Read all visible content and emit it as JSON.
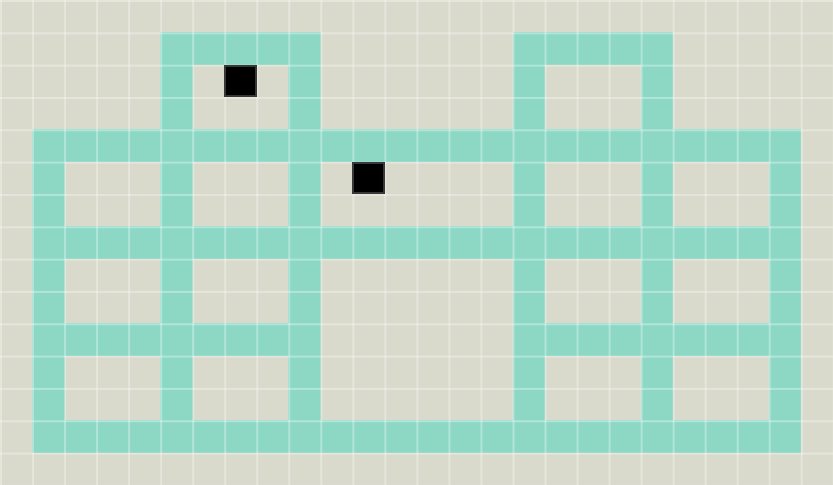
{
  "board": {
    "cols": 26,
    "rows": 15,
    "tile_size_px": 32,
    "legend": {
      ".": "floor",
      "W": "wall",
      "B": "black-block"
    },
    "rows_map": [
      "..........................",
      ".....WWWWW......WWWWW.....",
      ".....W.B.W......W...W.....",
      ".....W...W......W...W.....",
      ".WWWWWWWWWWWWWWWWWWWWWWWW.",
      ".W...W...W.B....W...W...W.",
      ".W...W...W......W...W...W.",
      ".WWWWWWWWWWWWWWWWWWWWWWWW.",
      ".W...W...W......W...W...W.",
      ".W...W...W......W...W...W.",
      ".WWWWWWWWW......WWWWWWWWW.",
      ".W...W...W......W...W...W.",
      ".W...W...W......W...W...W.",
      ".WWWWWWWWWWWWWWWWWWWWWWWW.",
      ".........................."
    ]
  },
  "entities": [
    {
      "name": "black-block",
      "col": 7,
      "row": 2
    },
    {
      "name": "black-block",
      "col": 11,
      "row": 5
    }
  ],
  "colors": {
    "floor": "#d9d9cc",
    "grid_line": "rgba(255,255,255,0.32)",
    "wall": "#8cd8c5",
    "block": "#000000",
    "block_border": "#383838"
  }
}
